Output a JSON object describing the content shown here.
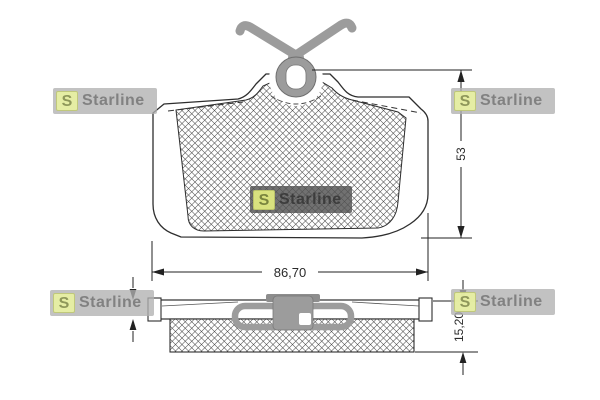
{
  "brand": {
    "name": "Starline",
    "initial": "S",
    "colors": {
      "badge_yellow": "#e7efa2",
      "badge_letter": "#8e975a",
      "watermark_box_light": "#b1b1b1",
      "watermark_text_light": "#7d7d7d",
      "watermark_box_dark": "#525252",
      "watermark_text_dark": "#3a3a3a"
    }
  },
  "views": {
    "front": {
      "width_label": "86,70",
      "height_label": "53"
    },
    "side": {
      "thickness_label": "15,20"
    }
  },
  "drawing_colors": {
    "outline": "#2e2e2e",
    "hatch_line": "#4a4a4a",
    "clip_gray": "#9c9c9c",
    "background": "#ffffff"
  }
}
